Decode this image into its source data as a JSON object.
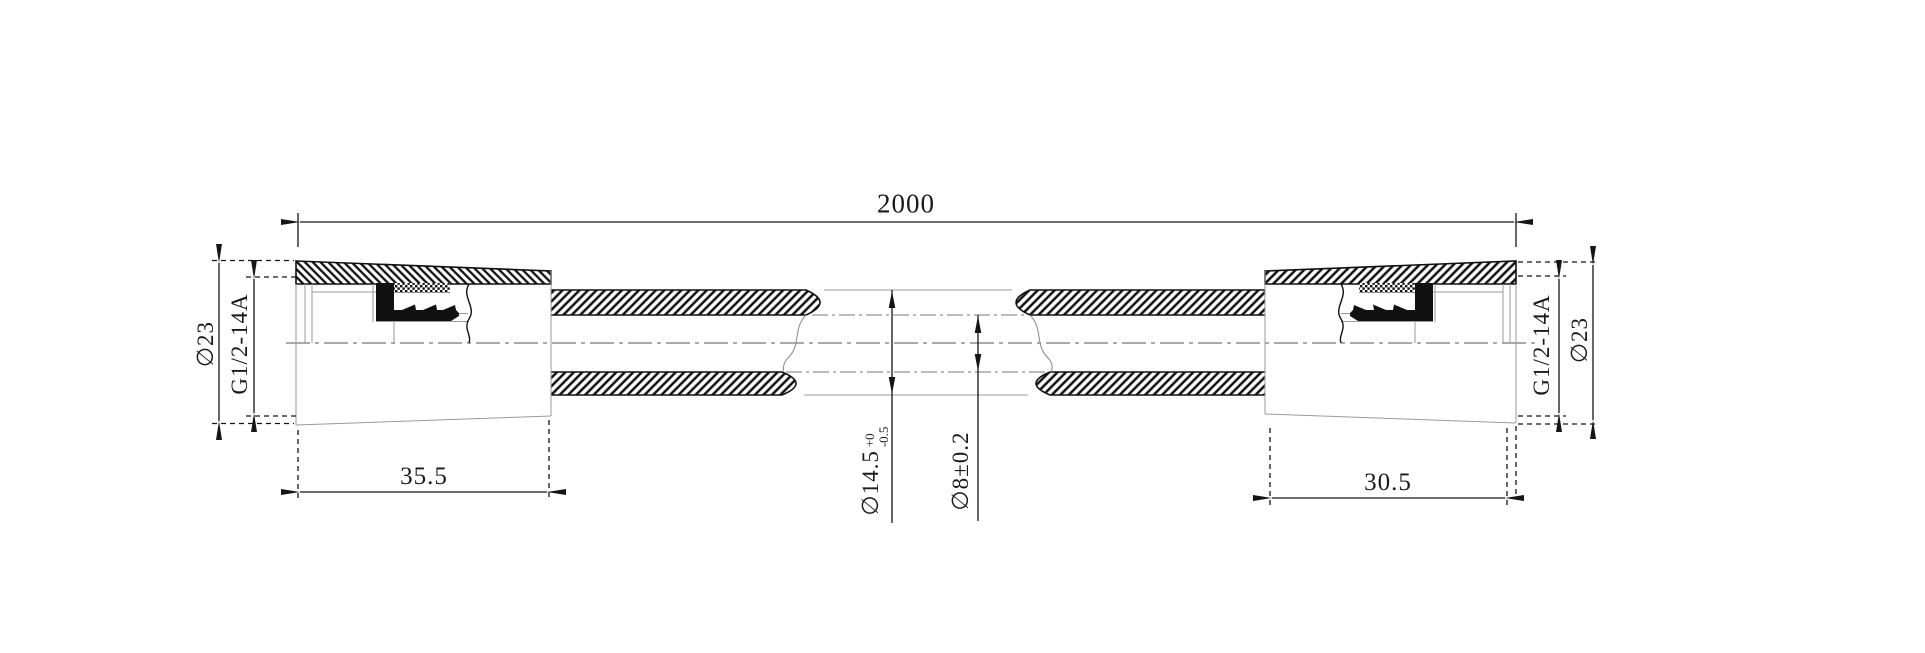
{
  "drawing": {
    "background_color": "#ffffff",
    "line_color": "#151515",
    "thin_line_color": "#9a9a9a",
    "labels": {
      "overall_length": "2000",
      "left_fitting_length": "35.5",
      "right_fitting_length": "30.5",
      "left_thread": "G1/2-14A",
      "right_thread": "G1/2-14A",
      "left_outside_diameter": "∅23",
      "right_outside_diameter": "∅23",
      "hose_outer_diameter": "∅14.5",
      "hose_outer_diameter_tol_upper": "+0",
      "hose_outer_diameter_tol_lower": "-0.5",
      "hose_bore_diameter": "∅8±0.2"
    }
  }
}
